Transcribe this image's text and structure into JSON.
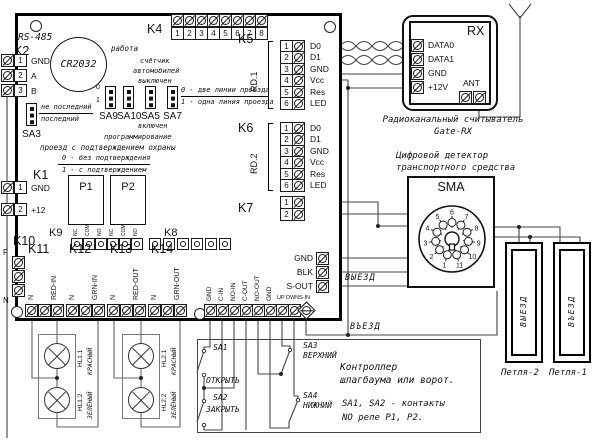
{
  "board": {
    "rs485": "RS-485",
    "battery": "CR2032",
    "k1": {
      "label": "K1",
      "pins": [
        {
          "n": "1",
          "name": "GND"
        },
        {
          "n": "2",
          "name": "+12"
        }
      ]
    },
    "k2": {
      "label": "K2",
      "pins": [
        {
          "n": "1",
          "name": "GND"
        },
        {
          "n": "2",
          "name": "A"
        },
        {
          "n": "3",
          "name": "B"
        }
      ]
    },
    "k4": {
      "label": "K4",
      "nums": [
        "1",
        "2",
        "3",
        "4",
        "5",
        "6",
        "7",
        "8"
      ]
    },
    "k5": {
      "label": "K5",
      "port": "RD.1",
      "pins": [
        {
          "n": "1",
          "name": "D0"
        },
        {
          "n": "2",
          "name": "D1"
        },
        {
          "n": "3",
          "name": "GND"
        },
        {
          "n": "4",
          "name": "Vcc"
        },
        {
          "n": "5",
          "name": "Res"
        },
        {
          "n": "6",
          "name": "LED"
        }
      ]
    },
    "k6": {
      "label": "K6",
      "port": "RD.2",
      "pins": [
        {
          "n": "1",
          "name": "D0"
        },
        {
          "n": "2",
          "name": "D1"
        },
        {
          "n": "3",
          "name": "GND"
        },
        {
          "n": "4",
          "name": "Vcc"
        },
        {
          "n": "5",
          "name": "Res"
        },
        {
          "n": "6",
          "name": "LED"
        }
      ]
    },
    "k7": {
      "label": "K7",
      "nums": [
        "1",
        "2"
      ]
    },
    "k8": {
      "label": "K8"
    },
    "k9": {
      "label": "K9",
      "pins": [
        "NC",
        "COM",
        "NO",
        "NC",
        "COM",
        "NO"
      ]
    },
    "k10": {
      "label": "K10",
      "fuse": "F",
      "neutral": "N"
    },
    "k11": {
      "label": "K11",
      "pin_n": "N",
      "pin_sig": "RED-IN"
    },
    "k12": {
      "label": "K12",
      "pin_n": "N",
      "pin_sig": "GRN-IN"
    },
    "k13": {
      "label": "K13",
      "pin_n": "N",
      "pin_sig": "RED-OUT"
    },
    "k14": {
      "label": "K14",
      "pin_n": "N",
      "pin_sig": "GRN-OUT"
    },
    "relay1": "P1",
    "relay2": "P2",
    "io_strip": {
      "vlabels": [
        "GND",
        "C-IN",
        "NO-IN",
        "C-OUT",
        "NO-OUT",
        "GND"
      ],
      "small": [
        "UP",
        "DWN",
        "S-IN"
      ]
    },
    "det_strip": {
      "labels": [
        "GND",
        "BLK",
        "S-OUT"
      ]
    },
    "jumpers": {
      "sa3": {
        "label": "SA3",
        "opt0": "не последний",
        "opt1": "последний"
      },
      "sa9": "SA9",
      "sa10": "SA10",
      "sa5": "SA5",
      "sa7": "SA7",
      "mark0": "0",
      "mark1": "1",
      "ann_work": "работа",
      "ann_counter1": "счётчик",
      "ann_counter2": "автомобилей",
      "ann_counter3": "выключен",
      "ann_on": "включен",
      "ann_prog": "программирование",
      "ann_lines0": "0 - две линии проезда",
      "ann_lines1": "1 - одна линия проезда",
      "ann_guard": "проезд с подтверждением охраны",
      "ann_guard0": "0 - без подтверждения",
      "ann_guard1": "1 - с подтверждением"
    }
  },
  "rx": {
    "title": "RX",
    "pins": [
      "DATA0",
      "DATA1",
      "GND",
      "+12V"
    ],
    "ant": "ANT",
    "caption1": "Радиоканальный считыватель",
    "caption2": "Gate-RX"
  },
  "sma": {
    "caption1": "Цифровой детектор",
    "caption2": "транспортного средства",
    "title": "SMA",
    "pins": [
      "1",
      "2",
      "3",
      "4",
      "5",
      "6",
      "7",
      "8",
      "9",
      "10",
      "11"
    ]
  },
  "signals": {
    "exit": "ВЫЕЗД",
    "entry": "ВЪЕЗД"
  },
  "loops": {
    "loop2_text": "ВЫЕЗД",
    "loop2_label": "Петля-2",
    "loop1_text": "ВЪЕЗД",
    "loop1_label": "Петля-1"
  },
  "controller": {
    "sw1": "SA1",
    "sw1_action": "ОТКРЫТЬ",
    "sw2": "SA2",
    "sw2_action": "ЗАКРЫТЬ",
    "sw3": "SA3",
    "sw3_pos": "ВЕРХНИЙ",
    "sw4": "SA4",
    "sw4_pos": "НИЖНИЙ",
    "caption1": "Контроллер",
    "caption2": "шлагбаума или ворот.",
    "note1": "SA1, SA2 - контакты",
    "note2": "NO реле P1, P2."
  },
  "lamps": {
    "hl11": "HL1.1",
    "hl11_color": "КРАСНЫЙ",
    "hl12": "HL1.2",
    "hl12_color": "ЗЕЛЁНЫЙ",
    "hl21": "HL2.1",
    "hl21_color": "КРАСНЫЙ",
    "hl22": "HL2.2",
    "hl22_color": "ЗЕЛЁНЫЙ"
  }
}
